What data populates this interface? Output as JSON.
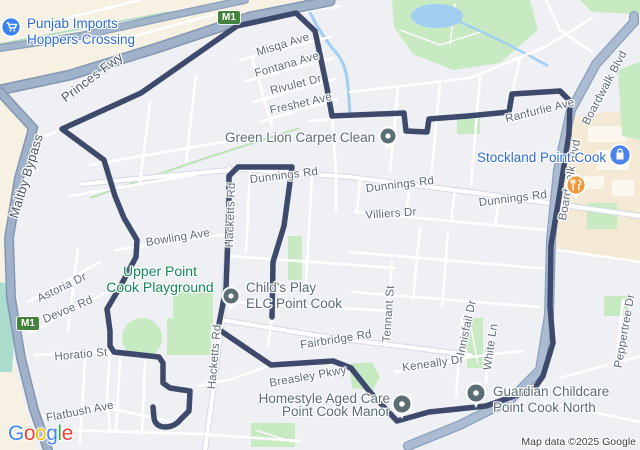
{
  "map": {
    "attribution": "Map data ©2025 Google",
    "logo": {
      "letters": [
        "G",
        "o",
        "o",
        "g",
        "l",
        "e"
      ]
    },
    "shields": [
      {
        "text": "M1"
      },
      {
        "text": "M1"
      }
    ],
    "colors": {
      "route": "#3e4a6b",
      "poi_pin": "#5b6e72",
      "stockland_pin": "#4a82ee",
      "restaurant_pin": "#ee9a3c",
      "business_blue": "#2e6bd0",
      "park_label_green": "#128a56"
    },
    "pois": {
      "punjab": {
        "line1": "Punjab Imports",
        "line2": "Hoppers Crossing",
        "icon": "shopping-cart-icon"
      },
      "stockland": {
        "label": "Stockland Point Cook",
        "icon": "shopping-bag-icon"
      },
      "restaurant": {
        "icon": "restaurant-icon"
      },
      "green_lion": {
        "label": "Green Lion Carpet Clean"
      },
      "childs_play": {
        "line1": "Child's Play",
        "line2": "ELC Point Cook"
      },
      "homestyle": {
        "line1": "Homestyle Aged Care",
        "line2": "Point Cook Manor"
      },
      "guardian": {
        "line1": "Guardian Childcare",
        "line2": "Point Cook North"
      },
      "playground": {
        "line1": "Upper Point",
        "line2": "Cook Playground"
      }
    },
    "streets": [
      {
        "text": "Princes Fwy"
      },
      {
        "text": "Maltby Bypass"
      },
      {
        "text": "Misqa Ave"
      },
      {
        "text": "Fontana Ave"
      },
      {
        "text": "Rivulet Dr"
      },
      {
        "text": "Freshet Ave"
      },
      {
        "text": "Ranfurlie Ave"
      },
      {
        "text": "Boardwalk Blvd"
      },
      {
        "text": "Boardwalk Blvd"
      },
      {
        "text": "Dunnings Rd"
      },
      {
        "text": "Dunnings Rd"
      },
      {
        "text": "Dunnings Rd"
      },
      {
        "text": "Villiers Dr"
      },
      {
        "text": "Bowling Ave"
      },
      {
        "text": "Hacketts Rd"
      },
      {
        "text": "Hacketts Rd"
      },
      {
        "text": "Tennant St"
      },
      {
        "text": "Fairbridge Rd"
      },
      {
        "text": "Keneally Dr"
      },
      {
        "text": "Breasley Pkwy"
      },
      {
        "text": "Innisfail Dr"
      },
      {
        "text": "White Ln"
      },
      {
        "text": "Peppertree Dr"
      },
      {
        "text": "Astoria Dr"
      },
      {
        "text": "Devoe Rd"
      },
      {
        "text": "Horatio St"
      },
      {
        "text": "Flatbush Ave"
      }
    ]
  }
}
